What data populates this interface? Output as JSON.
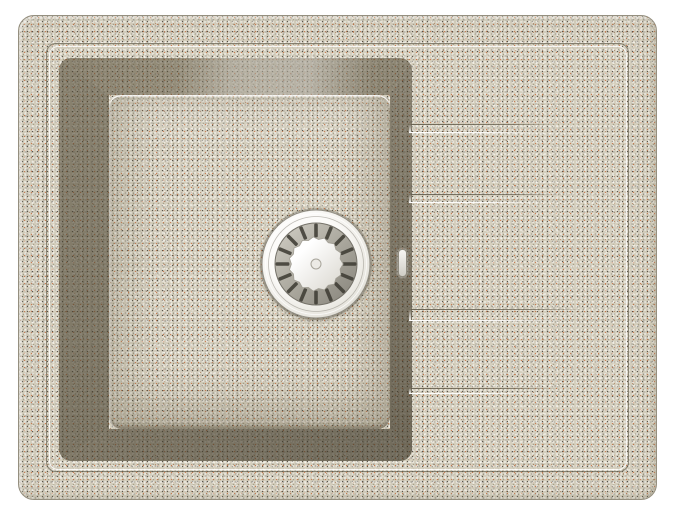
{
  "meta": {
    "type": "product-photo",
    "description": "Top-down view of a beige sand-speckled granite composite kitchen sink with a single rectangular bowl on the left, a chrome basket strainer drain inside the bowl, and a ribbed drainboard area on the right",
    "background_color": "#ffffff"
  },
  "sink": {
    "body": {
      "material": "speckled granite composite",
      "base_color": "#d5cfbe",
      "edge_color": "#958f7f",
      "speckle_colors": [
        "#fffffd",
        "#f6f2e8",
        "#444038",
        "#767a80",
        "#c76c3c",
        "#ac744e",
        "#968e74",
        "#34302a"
      ]
    },
    "rim": {
      "engraved_line": true,
      "inset_px": 27
    },
    "bowl": {
      "shape": "rectangular",
      "wall_colors": {
        "top": "#9a9179",
        "left": "#8d8570",
        "right": "#837b64",
        "bottom": "#88806a"
      },
      "floor_color": "#d6d0bf"
    },
    "drain": {
      "kind": "basket-strainer",
      "slot_count": 16,
      "cap_teeth": 15,
      "colors": {
        "flange": "#fcfbf9",
        "flange_edge": "#8f8c82",
        "ring_light": "#cdcac1",
        "ring_dark": "#8b887e",
        "slot": "#3f3c34",
        "cap_light": "#ffffff",
        "cap_dark": "#dbd8d0"
      }
    },
    "drainboard": {
      "groove_count": 4,
      "grooves": [
        {
          "x": 390,
          "y": 108,
          "w": 150,
          "h": 9
        },
        {
          "x": 390,
          "y": 178,
          "w": 152,
          "h": 9
        },
        {
          "x": 390,
          "y": 293,
          "w": 178,
          "h": 12
        },
        {
          "x": 390,
          "y": 372,
          "w": 152,
          "h": 6
        }
      ]
    },
    "overflow_notch": {
      "x": 379,
      "y": 233,
      "w": 7,
      "h": 26
    }
  }
}
